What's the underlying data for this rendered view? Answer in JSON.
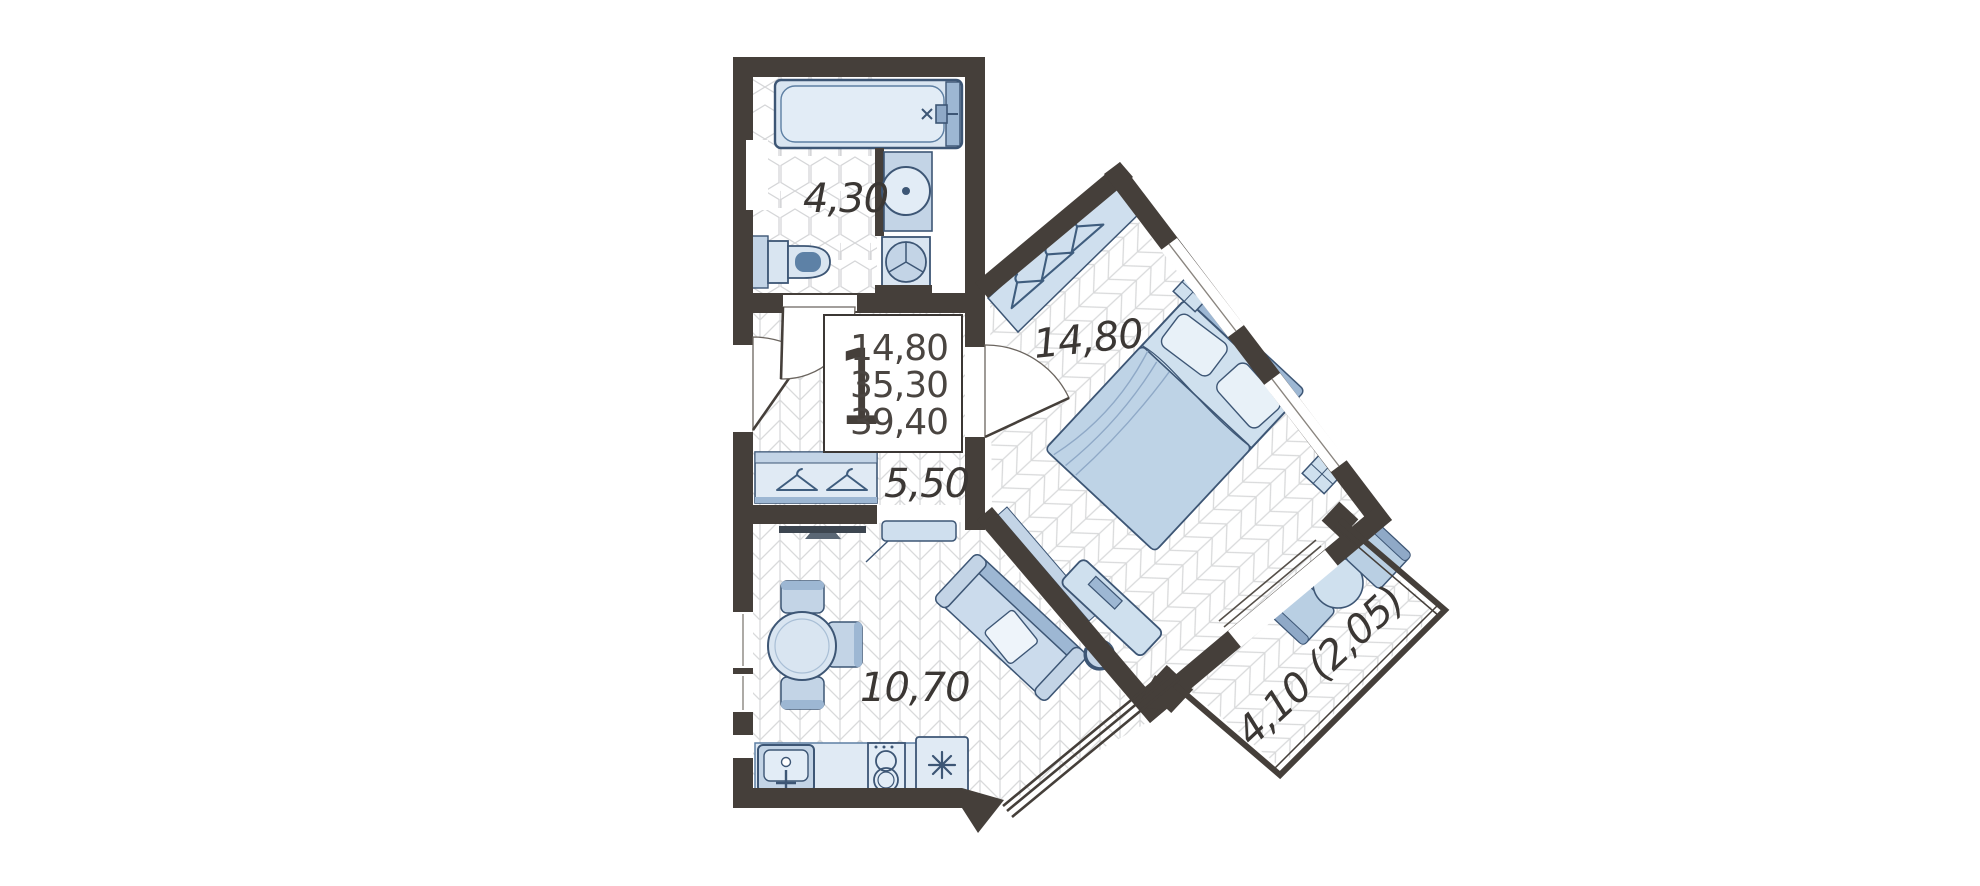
{
  "unit_card": {
    "rooms_count": "1",
    "living_area": "14,80",
    "floor_area": "35,30",
    "total_area": "39,40"
  },
  "rooms": {
    "bathroom": {
      "label": "4,30"
    },
    "hallway": {
      "label": "5,50"
    },
    "kitchen_living": {
      "label": "10,70"
    },
    "bedroom": {
      "label": "14,80"
    },
    "balcony": {
      "label": "4,10 (2,05)"
    }
  },
  "colors": {
    "wall": "#453f3a",
    "furniture_light": "#d9e5f1",
    "furniture_mid": "#c3d4e6",
    "furniture_dark": "#9db7d3",
    "outline": "#3d5675",
    "floor_line": "#d9dadb",
    "text": "#3b3734"
  }
}
